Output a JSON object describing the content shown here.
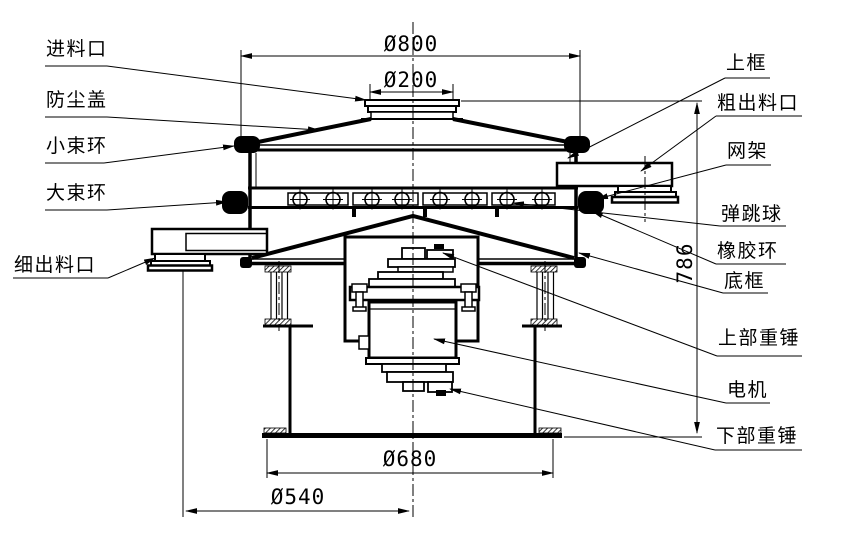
{
  "colors": {
    "line": "#000000",
    "background": "#ffffff"
  },
  "labels": {
    "left": [
      {
        "text": "进料口"
      },
      {
        "text": "防尘盖"
      },
      {
        "text": "小束环"
      },
      {
        "text": "大束环"
      },
      {
        "text": "细出料口"
      }
    ],
    "right": [
      {
        "text": "上框"
      },
      {
        "text": "粗出料口"
      },
      {
        "text": "网架"
      },
      {
        "text": "弹跳球"
      },
      {
        "text": "橡胶环"
      },
      {
        "text": "底框"
      },
      {
        "text": "上部重锤"
      },
      {
        "text": "电机"
      },
      {
        "text": "下部重锤"
      }
    ]
  },
  "dimensions": {
    "top_diameter": {
      "text": "Ø800"
    },
    "inlet_diameter": {
      "text": "Ø200"
    },
    "overall_height": {
      "text": "786"
    },
    "base_flange_diameter": {
      "text": "Ø680"
    },
    "base_inner_diameter": {
      "text": "Ø540"
    }
  }
}
